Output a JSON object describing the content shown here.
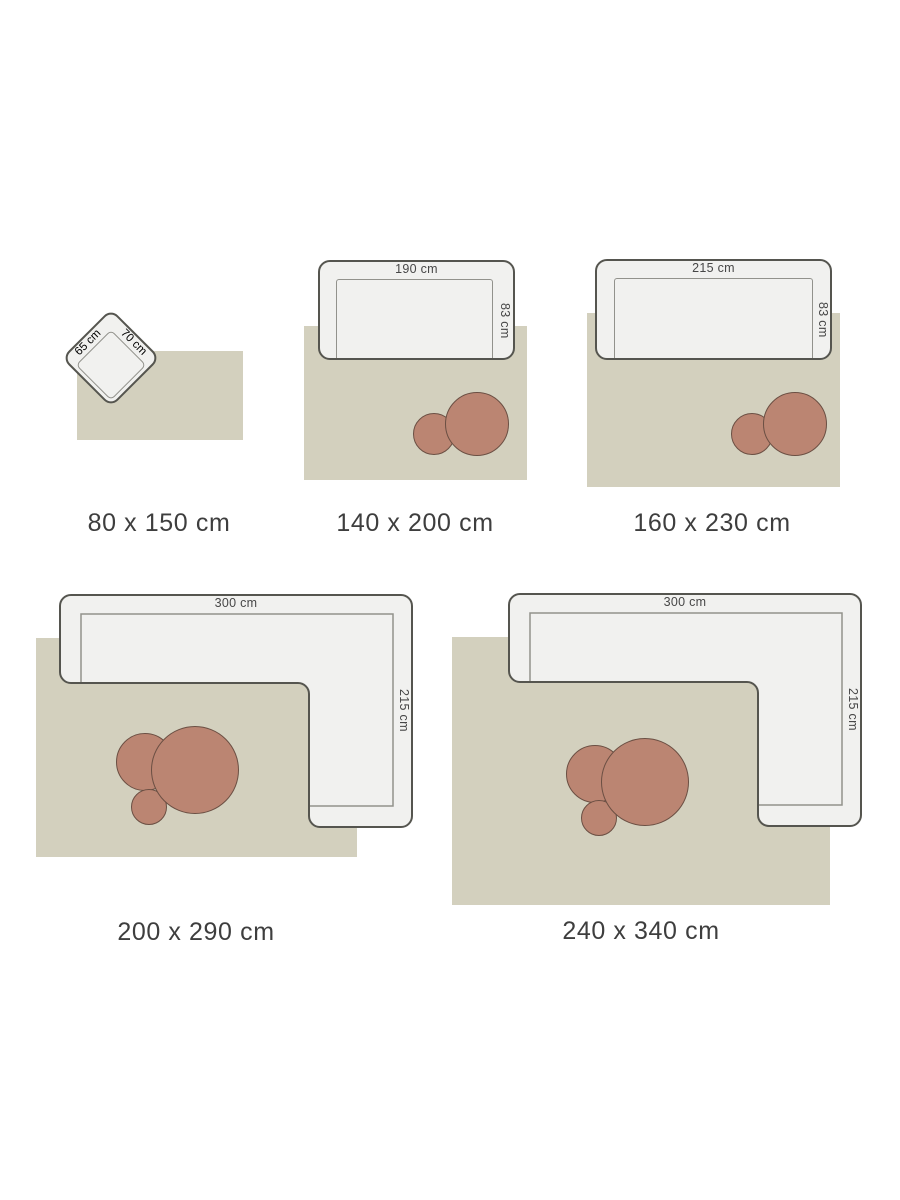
{
  "colors": {
    "rug": "#d3d0be",
    "sofa_fill": "#f1f1ef",
    "sofa_border": "#55554f",
    "seat_line": "#92928c",
    "table_fill": "#bb8572",
    "table_border": "#6b4f43",
    "dim_color": "#474747",
    "label_color": "#3e3e3e"
  },
  "diagrams": [
    {
      "rug_size": "80 x 150 cm",
      "furniture_width": "65 cm",
      "furniture_depth": "70 cm"
    },
    {
      "rug_size": "140 x 200 cm",
      "furniture_width": "190 cm",
      "furniture_depth": "83 cm"
    },
    {
      "rug_size": "160 x 230 cm",
      "furniture_width": "215 cm",
      "furniture_depth": "83 cm"
    },
    {
      "rug_size": "200 x 290 cm",
      "furniture_width": "300 cm",
      "furniture_depth": "215 cm"
    },
    {
      "rug_size": "240 x 340 cm",
      "furniture_width": "300 cm",
      "furniture_depth": "215 cm"
    }
  ]
}
